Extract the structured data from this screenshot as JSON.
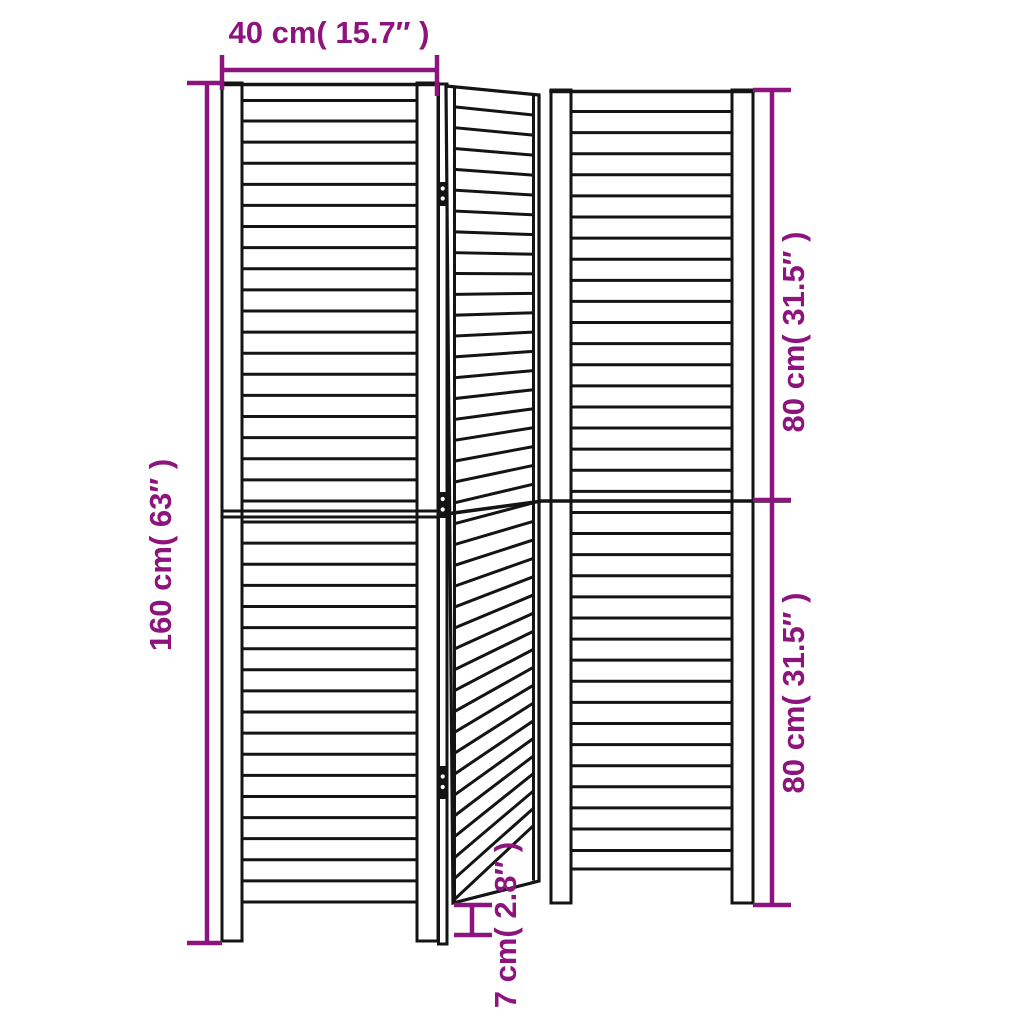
{
  "accent_color": "#8c147c",
  "line_color": "#141414",
  "background_color": "#ffffff",
  "product": {
    "type": "3-panel louvered room divider dimension diagram",
    "panel_count": 3
  },
  "dimensions": {
    "panel_width": "40 cm( 15.7″ )",
    "total_height": "160 cm( 63″ )",
    "upper_height": "80 cm( 31.5″ )",
    "lower_height": "80 cm( 31.5″ )",
    "foot_height": "7 cm( 2.8″ )"
  }
}
